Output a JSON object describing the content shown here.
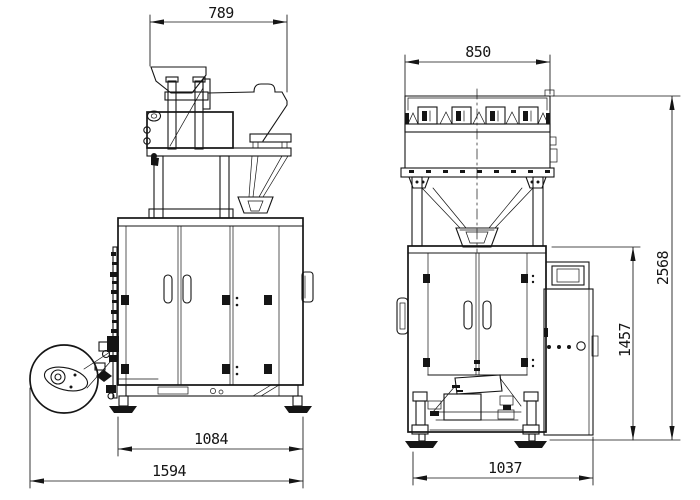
{
  "drawing": {
    "background": "#ffffff",
    "line_color": "#151515",
    "dimensions": {
      "side_top_width": "789",
      "side_frame_width": "1084",
      "side_overall_width": "1594",
      "front_top_width": "850",
      "front_base_width": "1037",
      "front_frame_height": "1457",
      "front_overall_height": "2568"
    }
  }
}
